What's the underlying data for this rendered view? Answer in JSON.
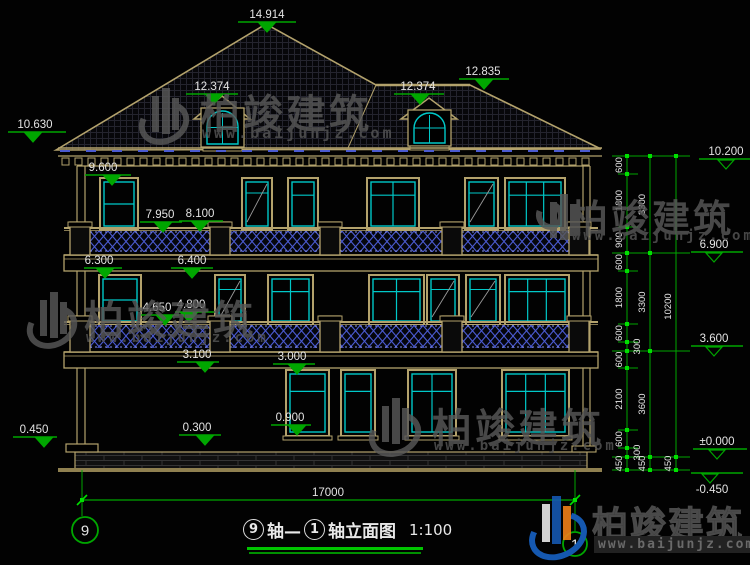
{
  "brand": {
    "name": "柏竣建筑",
    "url": "www.baijunjz.com"
  },
  "title_block": {
    "axis_start_bubble": "9",
    "axis_join": "轴—",
    "axis_end_bubble": "1",
    "title_rest": "轴立面图",
    "scale": "1:100"
  },
  "ground_axis": {
    "left_bubble": "9",
    "right_bubble": "1"
  },
  "dim_line": {
    "y": 500,
    "x1": 82,
    "x2": 575,
    "label": "17000",
    "lx": 328,
    "ly": 496
  },
  "markers_left": [
    {
      "v": "14.914",
      "tx": 267,
      "ty": 18,
      "ux": 238,
      "uw": 58,
      "uy": 22,
      "cx": 267
    },
    {
      "v": "12.374",
      "tx": 212,
      "ty": 90,
      "ux": 186,
      "uw": 52,
      "uy": 94,
      "cx": 214
    },
    {
      "v": "12.374",
      "tx": 418,
      "ty": 90,
      "ux": 394,
      "uw": 50,
      "uy": 94,
      "cx": 420
    },
    {
      "v": "12.835",
      "tx": 483,
      "ty": 75,
      "ux": 459,
      "uw": 50,
      "uy": 79,
      "cx": 484
    },
    {
      "v": "10.630",
      "tx": 35,
      "ty": 128,
      "ux": 8,
      "uw": 58,
      "uy": 132,
      "cx": 33
    },
    {
      "v": "9.600",
      "tx": 103,
      "ty": 171,
      "ux": 85,
      "uw": 46,
      "uy": 175,
      "cx": 112
    },
    {
      "v": "7.950",
      "tx": 160,
      "ty": 218,
      "ux": 140,
      "uw": 42,
      "uy": 222,
      "cx": 163
    },
    {
      "v": "8.100",
      "tx": 200,
      "ty": 217,
      "ux": 179,
      "uw": 44,
      "uy": 221,
      "cx": 200
    },
    {
      "v": "6.300",
      "tx": 99,
      "ty": 264,
      "ux": 84,
      "uw": 38,
      "uy": 268,
      "cx": 105
    },
    {
      "v": "6.400",
      "tx": 192,
      "ty": 264,
      "ux": 171,
      "uw": 42,
      "uy": 268,
      "cx": 192
    },
    {
      "v": "4.650",
      "tx": 157,
      "ty": 311,
      "ux": 141,
      "uw": 38,
      "uy": 315,
      "cx": 165
    },
    {
      "v": "4.800",
      "tx": 191,
      "ty": 308,
      "ux": 175,
      "uw": 40,
      "uy": 312,
      "cx": 189
    },
    {
      "v": "3.100",
      "tx": 197,
      "ty": 358,
      "ux": 177,
      "uw": 42,
      "uy": 362,
      "cx": 205
    },
    {
      "v": "3.000",
      "tx": 292,
      "ty": 360,
      "ux": 273,
      "uw": 42,
      "uy": 364,
      "cx": 297
    },
    {
      "v": "0.900",
      "tx": 290,
      "ty": 421,
      "ux": 271,
      "uw": 40,
      "uy": 425,
      "cx": 297
    },
    {
      "v": "0.450",
      "tx": 34,
      "ty": 433,
      "ux": 13,
      "uw": 44,
      "uy": 437,
      "cx": 44
    },
    {
      "v": "0.300",
      "tx": 197,
      "ty": 431,
      "ux": 179,
      "uw": 42,
      "uy": 435,
      "cx": 205
    }
  ],
  "markers_right": [
    {
      "v": "10.200",
      "tx": 726,
      "ty": 155,
      "ux": 699,
      "uw": 52,
      "uy": 159,
      "cx": 726
    },
    {
      "v": "6.900",
      "tx": 714,
      "ty": 248,
      "ux": 691,
      "uw": 52,
      "uy": 252,
      "cx": 714
    },
    {
      "v": "3.600",
      "tx": 714,
      "ty": 342,
      "ux": 691,
      "uw": 52,
      "uy": 346,
      "cx": 714
    },
    {
      "v": "±0.000",
      "tx": 717,
      "ty": 445,
      "ux": 693,
      "uw": 54,
      "uy": 449,
      "cx": 717
    },
    {
      "v": "-0.450",
      "tx": 712,
      "ty": 493,
      "ux": 691,
      "uw": 52,
      "uy": 473,
      "cx": 710,
      "below": true
    }
  ],
  "chains": [
    {
      "x": 627,
      "segs": [
        [
          "600",
          156,
          174
        ],
        [
          "1800",
          174,
          227
        ],
        [
          "900",
          227,
          253
        ],
        [
          "600",
          253,
          271
        ],
        [
          "1800",
          271,
          324
        ],
        [
          "600",
          324,
          342
        ],
        [
          "300",
          342,
          351,
          18
        ],
        [
          "600",
          351,
          368
        ],
        [
          "2100",
          368,
          430
        ],
        [
          "600",
          430,
          448
        ],
        [
          "300",
          448,
          457,
          18
        ],
        [
          "450",
          457,
          470
        ]
      ]
    },
    {
      "x": 650,
      "segs": [
        [
          "3300",
          156,
          253
        ],
        [
          "3300",
          253,
          351
        ],
        [
          "3600",
          351,
          457
        ],
        [
          "450",
          457,
          470
        ]
      ]
    },
    {
      "x": 676,
      "segs": [
        [
          "10200",
          156,
          457
        ],
        [
          "450",
          457,
          470
        ]
      ]
    }
  ],
  "levels_main": [
    156,
    253,
    351,
    457,
    470
  ],
  "levels_sub": [
    174,
    227,
    271,
    324,
    342,
    368,
    430,
    448
  ],
  "windows": {
    "floor3": {
      "y": 178,
      "h": 52,
      "items": [
        {
          "x": 100,
          "w": 38,
          "m": "mid"
        },
        {
          "x": 242,
          "w": 30,
          "m": "diag"
        },
        {
          "x": 288,
          "w": 30,
          "m": "plain"
        },
        {
          "x": 367,
          "w": 52,
          "m": "v1"
        },
        {
          "x": 465,
          "w": 33,
          "m": "diag"
        },
        {
          "x": 505,
          "w": 60,
          "m": "v2"
        }
      ]
    },
    "floor2": {
      "y": 275,
      "h": 50,
      "items": [
        {
          "x": 99,
          "w": 42,
          "m": "mid"
        },
        {
          "x": 215,
          "w": 30,
          "m": "diag"
        },
        {
          "x": 268,
          "w": 45,
          "m": "v1"
        },
        {
          "x": 369,
          "w": 55,
          "m": "v1"
        },
        {
          "x": 427,
          "w": 32,
          "m": "diag"
        },
        {
          "x": 466,
          "w": 34,
          "m": "diag"
        },
        {
          "x": 505,
          "w": 64,
          "m": "v2"
        }
      ]
    },
    "floor1": {
      "y": 370,
      "h": 66,
      "sill": true,
      "items": [
        {
          "x": 286,
          "w": 43,
          "m": "top"
        },
        {
          "x": 341,
          "w": 34,
          "m": "top"
        },
        {
          "x": 408,
          "w": 48,
          "m": "v1"
        },
        {
          "x": 502,
          "w": 67,
          "m": "v2"
        }
      ]
    }
  },
  "balustrades": [
    {
      "rail": 228,
      "lat_top": 231,
      "lat_bot": 252,
      "bot": 255
    },
    {
      "rail": 322,
      "lat_top": 325,
      "lat_bot": 348,
      "bot": 352
    }
  ],
  "piers": {
    "xs": [
      70,
      210,
      320,
      442,
      569
    ],
    "w": 20
  },
  "slabs": [
    {
      "y": 255,
      "h": 16
    },
    {
      "y": 352,
      "h": 16
    }
  ],
  "walls": {
    "left": [
      77,
      85
    ],
    "right": [
      583,
      590
    ],
    "top": 166,
    "bot": 452
  },
  "plinth": {
    "x": 75,
    "w": 512,
    "y": 452,
    "h": 18
  },
  "ground": {
    "x1": 58,
    "x2": 602,
    "y": 470
  },
  "eave": {
    "x1": 58,
    "x2": 602,
    "fascia_y": 148,
    "dentil_y": 158
  },
  "roof": {
    "pts": [
      [
        56,
        150
      ],
      [
        266,
        24
      ],
      [
        376,
        85
      ],
      [
        470,
        85
      ],
      [
        601,
        149
      ]
    ],
    "hip": [
      376,
      85,
      348,
      148
    ]
  },
  "dormers": [
    {
      "cx": 222,
      "apex": 96,
      "bx": 201,
      "bw": 43,
      "by": 108,
      "bh": 39
    },
    {
      "cx": 429,
      "apex": 98,
      "bx": 408,
      "bw": 43,
      "by": 110,
      "bh": 36
    }
  ],
  "axis_bubbles": [
    {
      "n": "9",
      "cx": 85,
      "cy": 530,
      "r": 13
    },
    {
      "n": "1",
      "cx": 575,
      "cy": 544,
      "r": 12
    }
  ],
  "colors": {
    "line": "#b3a26c",
    "cyan": "#00c8c8",
    "green": "#00a600",
    "green_bright": "#00e000",
    "blue": "#4a5ad0",
    "blue_light": "#8892ea",
    "white": "#e4e4e4",
    "mesh": "#24242e",
    "stone": "#343434",
    "diag": "#9a9a9a"
  }
}
